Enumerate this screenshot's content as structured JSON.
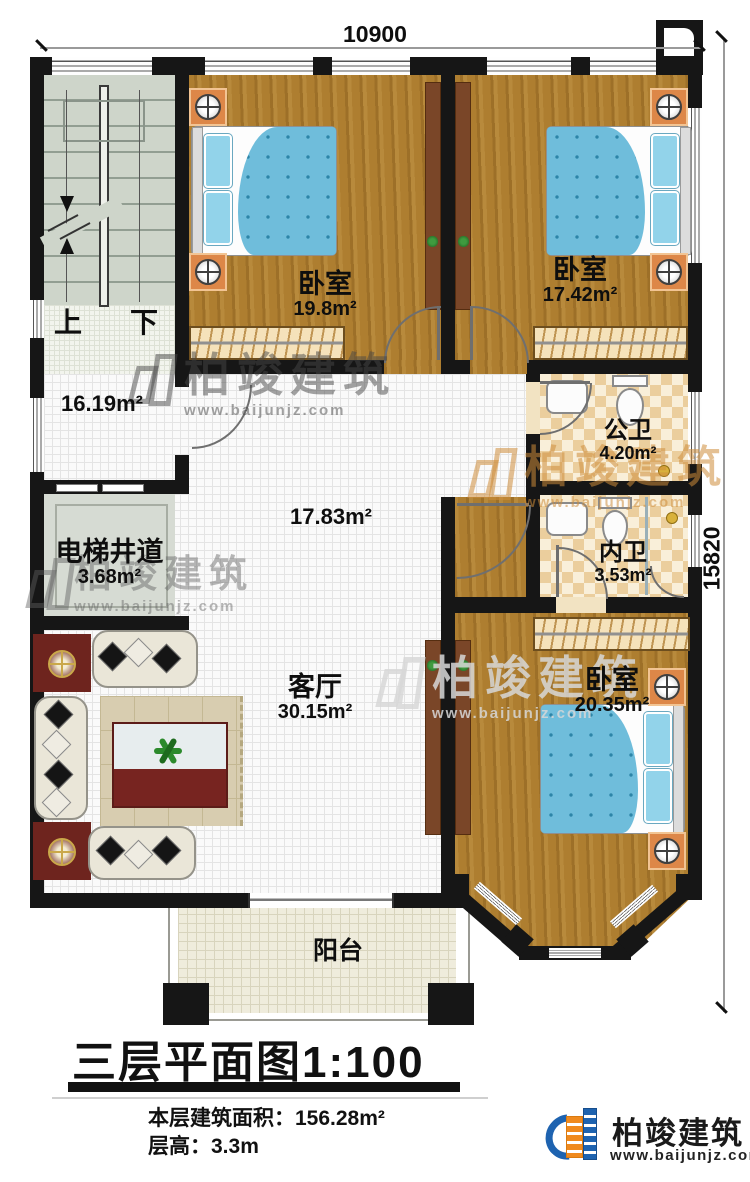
{
  "plan": {
    "dim_top": "10900",
    "dim_right": "15820",
    "rooms": {
      "bedroom1": {
        "label": "卧室",
        "area": "19.8m²"
      },
      "bedroom2": {
        "label": "卧室",
        "area": "17.42m²"
      },
      "bedroom3": {
        "label": "卧室",
        "area": "20.35m²"
      },
      "public_bath": {
        "label": "公卫",
        "area": "4.20m²"
      },
      "inner_bath": {
        "label": "内卫",
        "area": "3.53m²"
      },
      "hall": {
        "area": "16.19m²"
      },
      "corridor": {
        "area": "17.83m²"
      },
      "elevator": {
        "label": "电梯井道",
        "area": "3.68m²"
      },
      "living": {
        "label": "客厅",
        "area": "30.15m²"
      },
      "balcony": {
        "label": "阳台"
      }
    },
    "stairs": {
      "up": "上",
      "down": "下"
    }
  },
  "title": {
    "name": "三层平面图",
    "scale": "1:100"
  },
  "footer": {
    "area_label": "本层建筑面积：",
    "area_value": "156.28m²",
    "height_label": "层高：",
    "height_value": "3.3m"
  },
  "brand": {
    "name": "柏竣建筑",
    "url": "www.baijunjz.com"
  },
  "watermark": {
    "name": "柏竣建筑",
    "url": "www.baijunjz.com"
  },
  "colors": {
    "wall": "#161616",
    "brand_blue": "#1e63b0",
    "brand_orange": "#f08a1e",
    "bed_blue": "#6fbddb"
  }
}
